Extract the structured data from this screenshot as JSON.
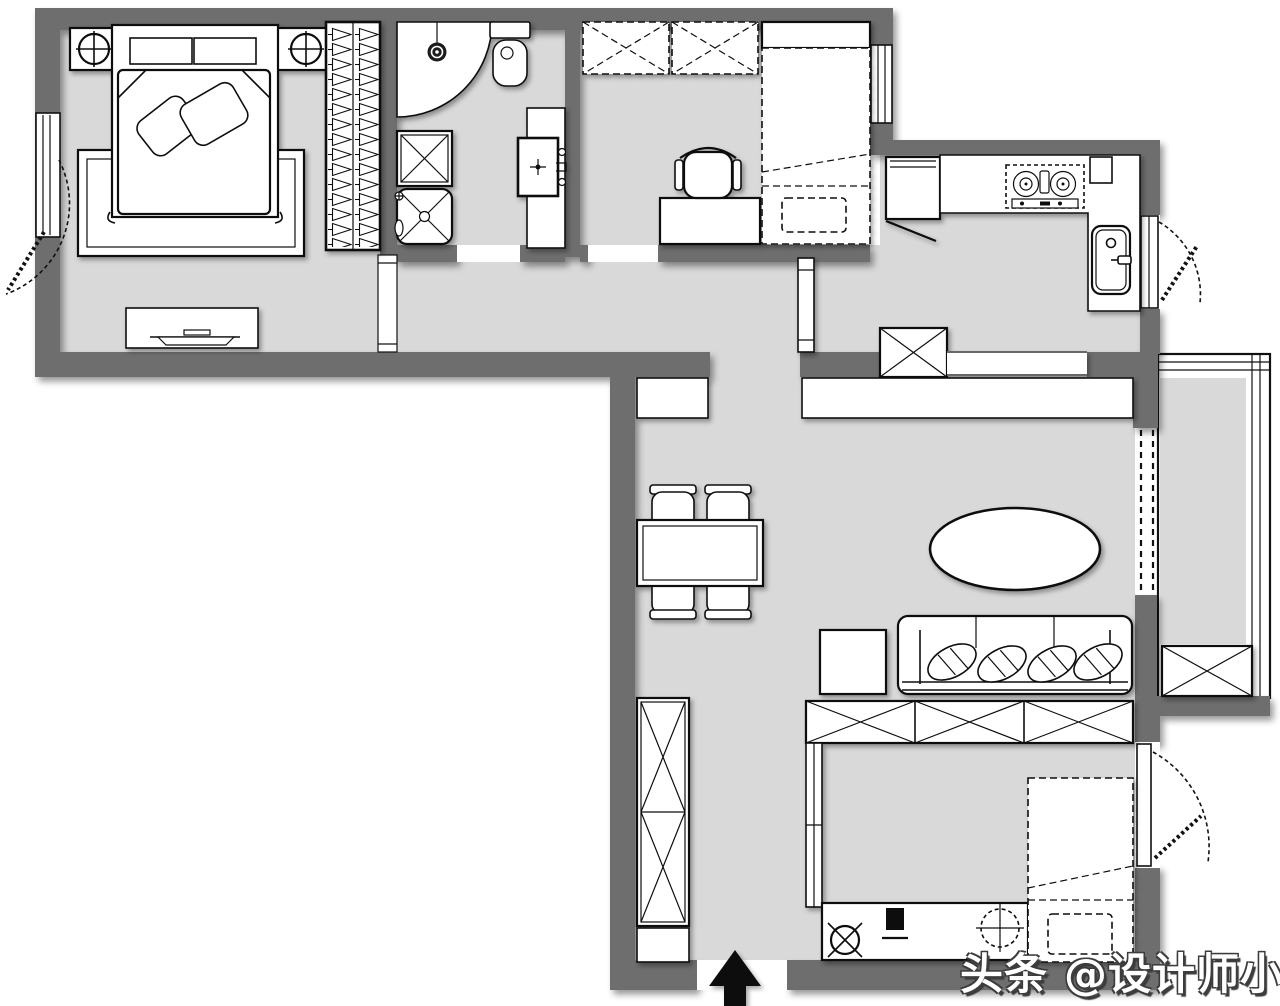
{
  "watermark": {
    "text": "头条 @设计师小晨"
  },
  "colors": {
    "bg": "#ffffff",
    "wall": "#6e6e6e",
    "floor": "#d9d9d9",
    "furniture": "#ffffff",
    "line": "#111111"
  }
}
